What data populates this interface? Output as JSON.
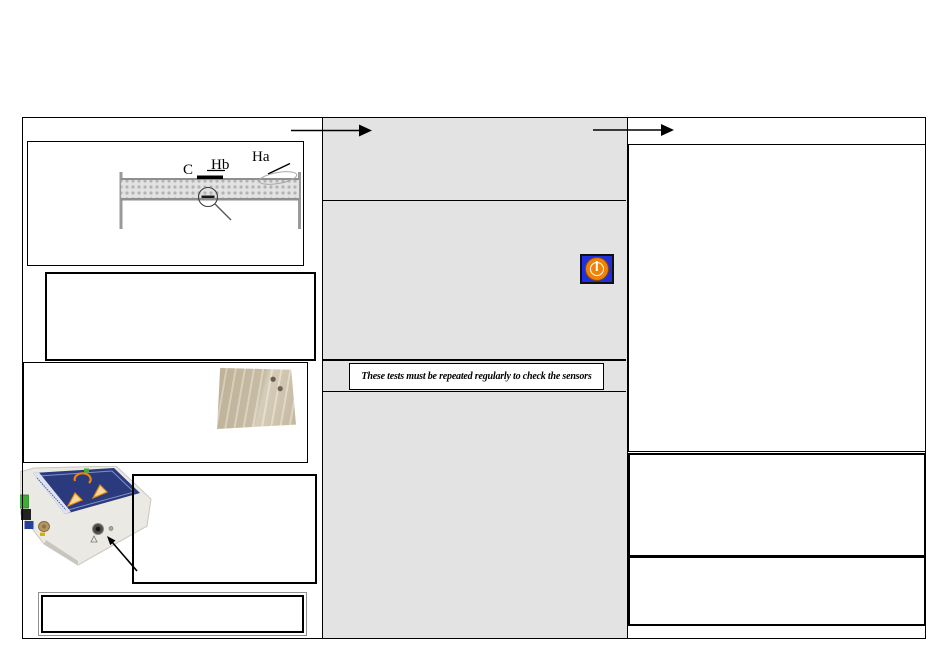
{
  "document": {
    "notice_text": "These tests must be repeated regularly to check the sensors",
    "diagram_labels": {
      "c": "C",
      "hb": "Hb",
      "ha": "Ha"
    },
    "colors": {
      "middle_panel_gray": "#e3e3e3",
      "border_black": "#000000",
      "power_button_blue": "#1f2fe0",
      "power_button_orange": "#f08208",
      "device_label_blue": "#2b3a7d",
      "connector_green": "#3fae35",
      "connector_brass": "#b39563",
      "fabric_beige": "#cbbfa8"
    },
    "icons": {
      "power": "power-icon",
      "flow_arrow": "arrow-right-icon",
      "magnifier": "magnifier-icon",
      "warning": "warning-triangle-icon"
    }
  }
}
